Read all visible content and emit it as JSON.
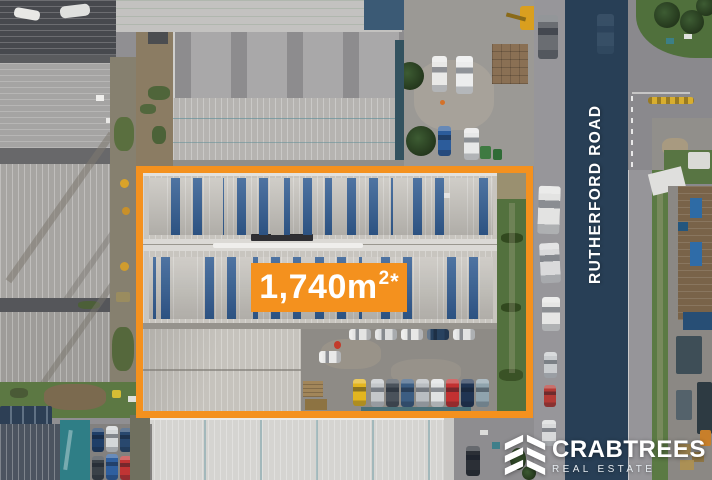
{
  "overlay": {
    "area_value": "1,740m",
    "area_sup": "2",
    "area_asterisk": "*",
    "road_name": "RUTHERFORD ROAD"
  },
  "brand": {
    "name": "CRABTREES",
    "tagline": "REAL ESTATE",
    "logo_icon": "stacked-chevron-blocks"
  },
  "colors": {
    "accent_orange": "#F4911E",
    "road_overlay_navy": "#1E3852",
    "solar_panel_blue": "#325D93",
    "grass_green": "#56743F"
  }
}
